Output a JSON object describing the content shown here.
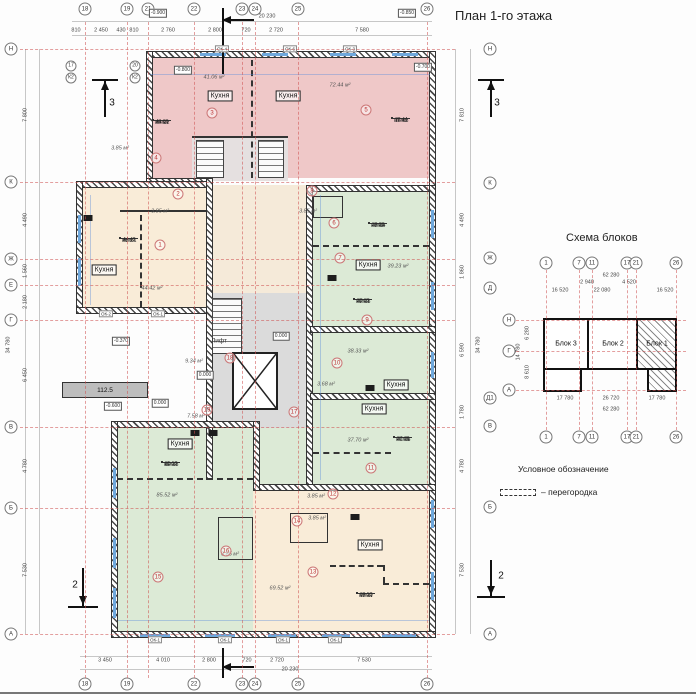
{
  "title": "План 1-го этажа",
  "legend": {
    "title": "Условное обозначение",
    "item": "– перегородка"
  },
  "scheme": {
    "title": "Схема блоков",
    "axes_top": [
      {
        "t": "1",
        "x": 546,
        "y": 263
      },
      {
        "t": "7",
        "x": 579,
        "y": 263
      },
      {
        "t": "11",
        "x": 592,
        "y": 263
      },
      {
        "t": "17",
        "x": 627,
        "y": 263
      },
      {
        "t": "21",
        "x": 636,
        "y": 263
      },
      {
        "t": "26",
        "x": 676,
        "y": 263
      }
    ],
    "axes_bottom": [
      {
        "t": "1",
        "x": 546,
        "y": 437
      },
      {
        "t": "7",
        "x": 579,
        "y": 437
      },
      {
        "t": "11",
        "x": 592,
        "y": 437
      },
      {
        "t": "17",
        "x": 627,
        "y": 437
      },
      {
        "t": "21",
        "x": 636,
        "y": 437
      },
      {
        "t": "26",
        "x": 676,
        "y": 437
      }
    ],
    "axes_left": [
      {
        "t": "Н",
        "x": 509,
        "y": 320
      },
      {
        "t": "Г",
        "x": 509,
        "y": 351
      },
      {
        "t": "А",
        "x": 509,
        "y": 390
      }
    ],
    "dims": [
      {
        "t": "62 280",
        "x": 611,
        "y": 276
      },
      {
        "t": "2 940",
        "x": 587,
        "y": 283
      },
      {
        "t": "4 520",
        "x": 629,
        "y": 283
      },
      {
        "t": "16 520",
        "x": 560,
        "y": 291
      },
      {
        "t": "22 080",
        "x": 602,
        "y": 291
      },
      {
        "t": "16 520",
        "x": 665,
        "y": 291
      },
      {
        "t": "17 780",
        "x": 565,
        "y": 399
      },
      {
        "t": "26 720",
        "x": 611,
        "y": 399
      },
      {
        "t": "17 780",
        "x": 657,
        "y": 399
      },
      {
        "t": "62 280",
        "x": 611,
        "y": 410
      },
      {
        "t": "6 280",
        "x": 528,
        "y": 333,
        "r": 1
      },
      {
        "t": "8 610",
        "x": 528,
        "y": 372,
        "r": 1
      },
      {
        "t": "14 780",
        "x": 519,
        "y": 352,
        "r": 1
      }
    ],
    "blocks": [
      {
        "t": "Блок 3",
        "x": 566,
        "y": 344
      },
      {
        "t": "Блок 2",
        "x": 613,
        "y": 344
      },
      {
        "t": "Блок 1",
        "x": 657,
        "y": 344
      }
    ]
  },
  "plan": {
    "ramp_label": "112.5",
    "lift": {
      "t": "Лифт",
      "x": 219,
      "y": 341
    },
    "axes_top": [
      {
        "t": "18",
        "x": 85,
        "y": 9
      },
      {
        "t": "19",
        "x": 127,
        "y": 9
      },
      {
        "t": "21",
        "x": 148,
        "y": 9
      },
      {
        "t": "22",
        "x": 194,
        "y": 9
      },
      {
        "t": "23",
        "x": 242,
        "y": 9
      },
      {
        "t": "24",
        "x": 255,
        "y": 9
      },
      {
        "t": "25",
        "x": 298,
        "y": 9
      },
      {
        "t": "26",
        "x": 427,
        "y": 9
      }
    ],
    "axes_bottom": [
      {
        "t": "18",
        "x": 85,
        "y": 684
      },
      {
        "t": "19",
        "x": 127,
        "y": 684
      },
      {
        "t": "22",
        "x": 194,
        "y": 684
      },
      {
        "t": "23",
        "x": 242,
        "y": 684
      },
      {
        "t": "24",
        "x": 255,
        "y": 684
      },
      {
        "t": "25",
        "x": 298,
        "y": 684
      },
      {
        "t": "26",
        "x": 427,
        "y": 684
      }
    ],
    "axes_left": [
      {
        "t": "Н",
        "x": 11,
        "y": 49
      },
      {
        "t": "К",
        "x": 11,
        "y": 182
      },
      {
        "t": "Ж",
        "x": 11,
        "y": 259
      },
      {
        "t": "Е",
        "x": 11,
        "y": 285
      },
      {
        "t": "Г",
        "x": 11,
        "y": 320
      },
      {
        "t": "В",
        "x": 11,
        "y": 427
      },
      {
        "t": "Б",
        "x": 11,
        "y": 508
      },
      {
        "t": "А",
        "x": 11,
        "y": 634
      }
    ],
    "axes_right": [
      {
        "t": "Н",
        "x": 490,
        "y": 49
      },
      {
        "t": "К",
        "x": 490,
        "y": 183
      },
      {
        "t": "Ж",
        "x": 490,
        "y": 258
      },
      {
        "t": "Д",
        "x": 490,
        "y": 288
      },
      {
        "t": "Д1",
        "x": 490,
        "y": 398
      },
      {
        "t": "В",
        "x": 490,
        "y": 426
      },
      {
        "t": "Б",
        "x": 490,
        "y": 507
      },
      {
        "t": "А",
        "x": 490,
        "y": 634
      }
    ],
    "axes_extra": [
      {
        "t": "17",
        "x": 71,
        "y": 66
      },
      {
        "t": "К2",
        "x": 71,
        "y": 78
      },
      {
        "t": "20",
        "x": 135,
        "y": 66
      },
      {
        "t": "К2",
        "x": 135,
        "y": 78
      }
    ],
    "dims_top": [
      {
        "t": "810",
        "x": 76,
        "y": 31
      },
      {
        "t": "2 450",
        "x": 101,
        "y": 31
      },
      {
        "t": "430",
        "x": 121,
        "y": 31
      },
      {
        "t": "810",
        "x": 134,
        "y": 31
      },
      {
        "t": "2 760",
        "x": 168,
        "y": 31
      },
      {
        "t": "2 800",
        "x": 215,
        "y": 31
      },
      {
        "t": "720",
        "x": 246,
        "y": 31
      },
      {
        "t": "2 720",
        "x": 276,
        "y": 31
      },
      {
        "t": "7 580",
        "x": 362,
        "y": 31
      }
    ],
    "dims_bottom": [
      {
        "t": "3 450",
        "x": 105,
        "y": 661
      },
      {
        "t": "4 010",
        "x": 163,
        "y": 661
      },
      {
        "t": "2 800",
        "x": 209,
        "y": 661
      },
      {
        "t": "720",
        "x": 247,
        "y": 661
      },
      {
        "t": "2 720",
        "x": 277,
        "y": 661
      },
      {
        "t": "7 530",
        "x": 364,
        "y": 661
      }
    ],
    "dims_left": [
      {
        "t": "7 800",
        "x": 26,
        "y": 115,
        "r": 1
      },
      {
        "t": "4 490",
        "x": 26,
        "y": 220,
        "r": 1
      },
      {
        "t": "1 560",
        "x": 26,
        "y": 271,
        "r": 1
      },
      {
        "t": "2 180",
        "x": 26,
        "y": 302,
        "r": 1
      },
      {
        "t": "6 450",
        "x": 26,
        "y": 375,
        "r": 1
      },
      {
        "t": "4 780",
        "x": 26,
        "y": 466,
        "r": 1
      },
      {
        "t": "7 530",
        "x": 26,
        "y": 570,
        "r": 1
      }
    ],
    "dims_right": [
      {
        "t": "7 810",
        "x": 463,
        "y": 115,
        "r": 1
      },
      {
        "t": "4 490",
        "x": 463,
        "y": 220,
        "r": 1
      },
      {
        "t": "1 860",
        "x": 463,
        "y": 272,
        "r": 1
      },
      {
        "t": "6 590",
        "x": 463,
        "y": 350,
        "r": 1
      },
      {
        "t": "1 780",
        "x": 463,
        "y": 412,
        "r": 1
      },
      {
        "t": "4 780",
        "x": 463,
        "y": 466,
        "r": 1
      },
      {
        "t": "7 530",
        "x": 463,
        "y": 570,
        "r": 1
      }
    ],
    "totals": [
      {
        "t": "20 230",
        "x": 267,
        "y": 17
      },
      {
        "t": "20 230",
        "x": 290,
        "y": 670
      },
      {
        "t": "34 780",
        "x": 9,
        "y": 345,
        "r": 1
      },
      {
        "t": "34 780",
        "x": 479,
        "y": 345,
        "r": 1
      }
    ],
    "elevations": [
      {
        "t": "-0.900",
        "x": 158,
        "y": 13
      },
      {
        "t": "-0.850",
        "x": 407,
        "y": 13
      },
      {
        "t": "-0.800",
        "x": 183,
        "y": 70
      },
      {
        "t": "-0.700",
        "x": 423,
        "y": 67
      },
      {
        "t": "-0.370",
        "x": 121,
        "y": 341
      },
      {
        "t": "-0.600",
        "x": 113,
        "y": 406
      },
      {
        "t": "0.000",
        "x": 160,
        "y": 403
      },
      {
        "t": "0.000",
        "x": 281,
        "y": 336
      },
      {
        "t": "0.000",
        "x": 205,
        "y": 375
      }
    ],
    "kitchens": [
      {
        "t": "Кухня",
        "x": 220,
        "y": 96
      },
      {
        "t": "Кухня",
        "x": 288,
        "y": 96
      },
      {
        "t": "Кухня",
        "x": 104,
        "y": 270
      },
      {
        "t": "Кухня",
        "x": 368,
        "y": 265
      },
      {
        "t": "Кухня",
        "x": 396,
        "y": 385
      },
      {
        "t": "Кухня",
        "x": 374,
        "y": 409
      },
      {
        "t": "Кухня",
        "x": 180,
        "y": 444
      },
      {
        "t": "Кухня",
        "x": 370,
        "y": 545
      }
    ],
    "areas": [
      {
        "t": "41.06 м²",
        "x": 214,
        "y": 78
      },
      {
        "t": "72.44 м²",
        "x": 340,
        "y": 86
      },
      {
        "t": "3.85 м²",
        "x": 120,
        "y": 149
      },
      {
        "t": "3.85 м²",
        "x": 160,
        "y": 212
      },
      {
        "t": "3.85 м²",
        "x": 308,
        "y": 212
      },
      {
        "t": "44.42 м²",
        "x": 152,
        "y": 289
      },
      {
        "t": "39.23 м²",
        "x": 398,
        "y": 267
      },
      {
        "t": "38.33 м²",
        "x": 358,
        "y": 352
      },
      {
        "t": "3.68 м²",
        "x": 326,
        "y": 385
      },
      {
        "t": "9.34 м²",
        "x": 194,
        "y": 362
      },
      {
        "t": "7.58 м²",
        "x": 196,
        "y": 417
      },
      {
        "t": "37.70 м²",
        "x": 358,
        "y": 441
      },
      {
        "t": "85.52 м²",
        "x": 167,
        "y": 496
      },
      {
        "t": "3.85 м²",
        "x": 316,
        "y": 497
      },
      {
        "t": "3.85 м²",
        "x": 317,
        "y": 519
      },
      {
        "t": "3.85 м²",
        "x": 230,
        "y": 555
      },
      {
        "t": "69.52 м²",
        "x": 280,
        "y": 589
      }
    ],
    "apartments": [
      {
        "l": "кв №1",
        "a": "44.42",
        "b": "48.27",
        "x": 120,
        "y": 238
      },
      {
        "l": "кв №2",
        "a": "41.06",
        "b": "44.91",
        "x": 153,
        "y": 120
      },
      {
        "l": "кв №3",
        "a": "72.44",
        "b": "76.42",
        "x": 392,
        "y": 118
      },
      {
        "l": "кв №4",
        "a": "39.23",
        "b": "43.08",
        "x": 369,
        "y": 223
      },
      {
        "l": "кв №5",
        "a": "38.33",
        "b": "42.01",
        "x": 354,
        "y": 299
      },
      {
        "l": "кв №6",
        "a": "37.70",
        "b": "41.05",
        "x": 394,
        "y": 437
      },
      {
        "l": "кв №7",
        "a": "69.52",
        "b": "73.31",
        "x": 357,
        "y": 593
      },
      {
        "l": "кв №8",
        "a": "85.52",
        "b": "89.31",
        "x": 162,
        "y": 462
      }
    ],
    "room_numbers": [
      {
        "t": "1",
        "x": 160,
        "y": 245
      },
      {
        "t": "2",
        "x": 178,
        "y": 194
      },
      {
        "t": "3",
        "x": 212,
        "y": 113
      },
      {
        "t": "4",
        "x": 156,
        "y": 158
      },
      {
        "t": "5",
        "x": 366,
        "y": 110
      },
      {
        "t": "6",
        "x": 334,
        "y": 223
      },
      {
        "t": "7",
        "x": 340,
        "y": 258
      },
      {
        "t": "8",
        "x": 312,
        "y": 191
      },
      {
        "t": "9",
        "x": 367,
        "y": 320
      },
      {
        "t": "10",
        "x": 337,
        "y": 363
      },
      {
        "t": "11",
        "x": 371,
        "y": 468
      },
      {
        "t": "12",
        "x": 333,
        "y": 494
      },
      {
        "t": "13",
        "x": 313,
        "y": 572
      },
      {
        "t": "14",
        "x": 297,
        "y": 521
      },
      {
        "t": "15",
        "x": 158,
        "y": 577
      },
      {
        "t": "16",
        "x": 226,
        "y": 551
      },
      {
        "t": "17",
        "x": 294,
        "y": 412
      },
      {
        "t": "18",
        "x": 230,
        "y": 358
      },
      {
        "t": "19",
        "x": 207,
        "y": 410
      }
    ],
    "windows": [
      {
        "t": "ОК-4",
        "x": 222,
        "y": 49
      },
      {
        "t": "ОК-6",
        "x": 290,
        "y": 49
      },
      {
        "t": "ОК-3",
        "x": 350,
        "y": 49
      },
      {
        "t": "ОК-2",
        "x": 106,
        "y": 314
      },
      {
        "t": "ОК-1",
        "x": 158,
        "y": 314
      },
      {
        "t": "ОК-1",
        "x": 155,
        "y": 640
      },
      {
        "t": "ОК-1",
        "x": 225,
        "y": 640
      },
      {
        "t": "ОК-1",
        "x": 283,
        "y": 640
      },
      {
        "t": "ОК-1",
        "x": 335,
        "y": 640
      }
    ],
    "sections": [
      {
        "t": "3",
        "x": 112,
        "y": 103
      },
      {
        "t": "3",
        "x": 497,
        "y": 103
      },
      {
        "t": "2",
        "x": 75,
        "y": 585
      },
      {
        "t": "2",
        "x": 501,
        "y": 576
      }
    ],
    "vents": [
      {
        "x": 88,
        "y": 218
      },
      {
        "x": 332,
        "y": 278
      },
      {
        "x": 195,
        "y": 433
      },
      {
        "x": 213,
        "y": 433
      },
      {
        "x": 355,
        "y": 517
      },
      {
        "x": 370,
        "y": 388
      }
    ]
  }
}
